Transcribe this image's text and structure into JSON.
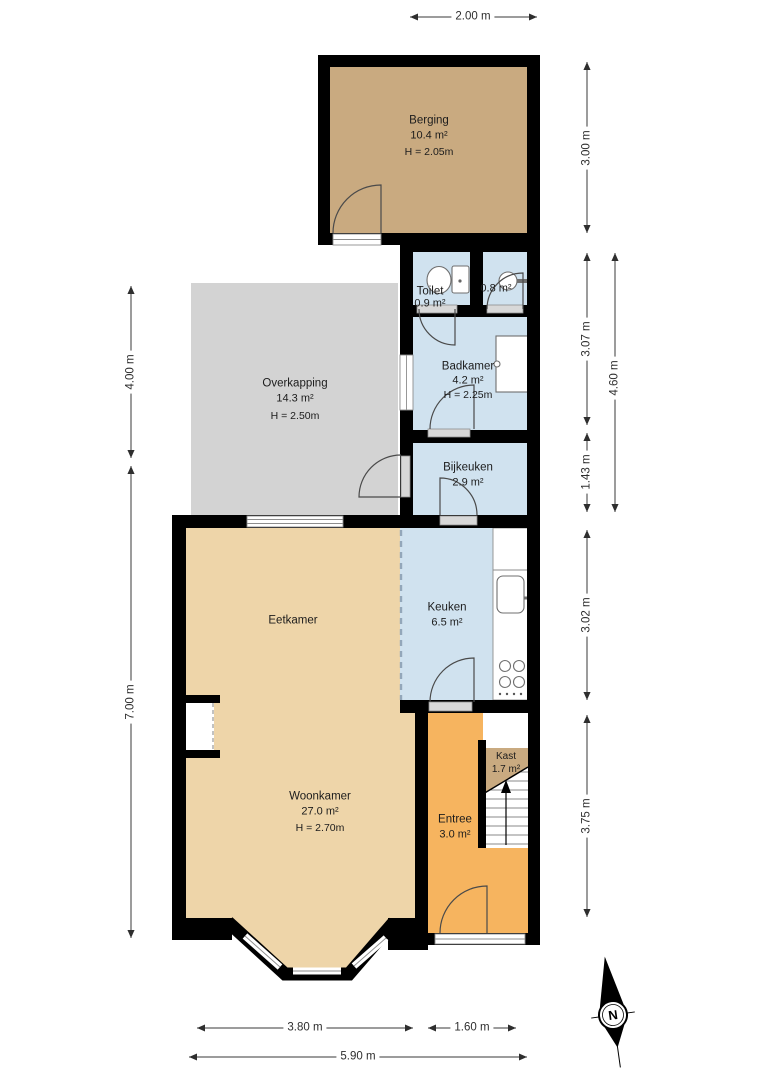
{
  "colors": {
    "wall": "#000000",
    "room-blue": "#d0e2ef",
    "room-tan": "#eed5a9",
    "room-berging": "#c9aa80",
    "room-gray": "#d3d3d3",
    "room-orange": "#f6b45f",
    "threshold": "#d8d8d8",
    "dim-line": "#3a3a3a",
    "text": "#1c1c1c"
  },
  "rooms": {
    "berging": {
      "name": "Berging",
      "area": "10.4 m²",
      "height": "H = 2.05m"
    },
    "overkapping": {
      "name": "Overkapping",
      "area": "14.3 m²",
      "height": "H = 2.50m"
    },
    "toilet": {
      "name": "Toilet",
      "area": "0.9 m²"
    },
    "washroom": {
      "area": "0.8 m²"
    },
    "badkamer": {
      "name": "Badkamer",
      "area": "4.2 m²",
      "height": "H = 2.25m"
    },
    "bijkeuken": {
      "name": "Bijkeuken",
      "area": "2.9 m²"
    },
    "eetkamer": {
      "name": "Eetkamer"
    },
    "keuken": {
      "name": "Keuken",
      "area": "6.5 m²"
    },
    "woonkamer": {
      "name": "Woonkamer",
      "area": "27.0 m²",
      "height": "H = 2.70m"
    },
    "kast": {
      "name": "Kast",
      "area": "1.7 m²"
    },
    "entree": {
      "name": "Entree",
      "area": "3.0 m²"
    }
  },
  "dimensions": {
    "top_width": "2.00 m",
    "left_upper": "4.00 m",
    "left_lower": "7.00 m",
    "right_1": "3.00 m",
    "right_2": "3.07 m",
    "right_mid": "4.60 m",
    "right_3": "1.43 m",
    "right_4": "3.02 m",
    "right_5": "3.75 m",
    "bottom_left": "3.80 m",
    "bottom_right": "1.60 m",
    "bottom_total": "5.90 m"
  },
  "compass": {
    "label": "N"
  }
}
